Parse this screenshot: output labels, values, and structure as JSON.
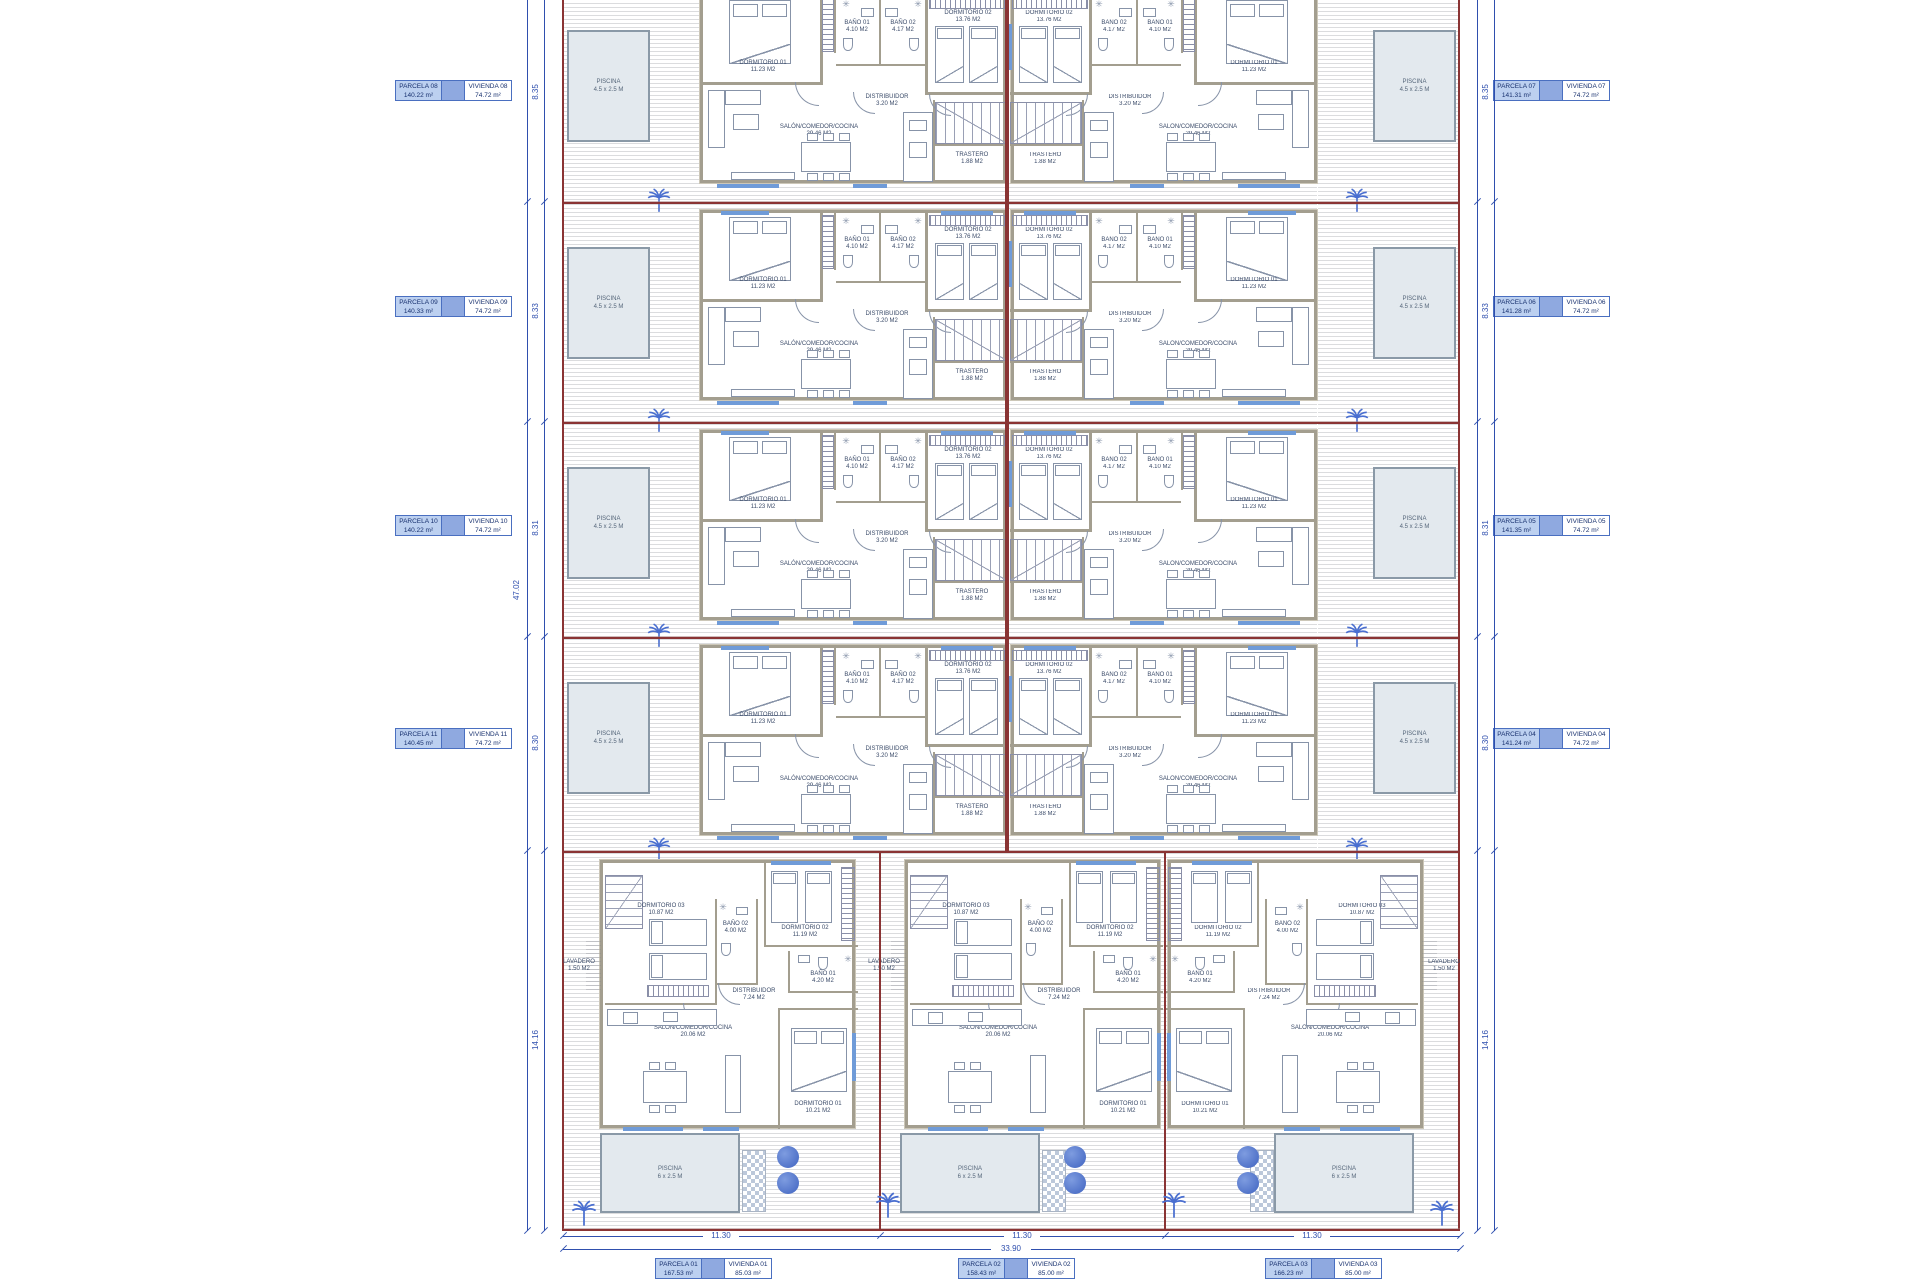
{
  "parcel_labels": {
    "left": [
      {
        "parcela": "PARCELA 08",
        "parcela_area": "140.22 m²",
        "vivienda": "VIVIENDA 08",
        "vivienda_area": "74.72 m²"
      },
      {
        "parcela": "PARCELA 09",
        "parcela_area": "140.33 m²",
        "vivienda": "VIVIENDA 09",
        "vivienda_area": "74.72 m²"
      },
      {
        "parcela": "PARCELA 10",
        "parcela_area": "140.22 m²",
        "vivienda": "VIVIENDA 10",
        "vivienda_area": "74.72 m²"
      },
      {
        "parcela": "PARCELA 11",
        "parcela_area": "140.45 m²",
        "vivienda": "VIVIENDA 11",
        "vivienda_area": "74.72 m²"
      }
    ],
    "right": [
      {
        "parcela": "PARCELA 07",
        "parcela_area": "141.31 m²",
        "vivienda": "VIVIENDA 07",
        "vivienda_area": "74.72 m²"
      },
      {
        "parcela": "PARCELA 06",
        "parcela_area": "141.28 m²",
        "vivienda": "VIVIENDA 06",
        "vivienda_area": "74.72 m²"
      },
      {
        "parcela": "PARCELA 05",
        "parcela_area": "141.35 m²",
        "vivienda": "VIVIENDA 05",
        "vivienda_area": "74.72 m²"
      },
      {
        "parcela": "PARCELA 04",
        "parcela_area": "141.24 m²",
        "vivienda": "VIVIENDA 04",
        "vivienda_area": "74.72 m²"
      }
    ],
    "bottom": [
      {
        "parcela": "PARCELA 01",
        "parcela_area": "167.53 m²",
        "vivienda": "VIVIENDA 01",
        "vivienda_area": "85.03 m²"
      },
      {
        "parcela": "PARCELA 02",
        "parcela_area": "158.43 m²",
        "vivienda": "VIVIENDA 02",
        "vivienda_area": "85.00 m²"
      },
      {
        "parcela": "PARCELA 03",
        "parcela_area": "166.23 m²",
        "vivienda": "VIVIENDA 03",
        "vivienda_area": "85.00 m²"
      }
    ]
  },
  "rooms": {
    "upper": {
      "d01": {
        "name": "DORMITORIO 01",
        "area": "11.23 M2"
      },
      "d02": {
        "name": "DORMITORIO 02",
        "area": "13.76 M2"
      },
      "b1": {
        "name": "BAÑO 01",
        "area": "4.10 M2"
      },
      "b2": {
        "name": "BAÑO 02",
        "area": "4.17 M2"
      },
      "dist": {
        "name": "DISTRIBUIDOR",
        "area": "3.20 M2"
      },
      "salon": {
        "name": "SALÓN/COMEDOR/COCINA",
        "area": "29.46 M2"
      },
      "trastero": {
        "name": "TRASTERO",
        "area": "1.88 M2"
      }
    },
    "lower": {
      "d01": {
        "name": "DORMITORIO 01",
        "area": "10.21 M2"
      },
      "d02": {
        "name": "DORMITORIO 02",
        "area": "11.19 M2"
      },
      "d03": {
        "name": "DORMITORIO 03",
        "area": "10.87 M2"
      },
      "b1": {
        "name": "BAÑO 01",
        "area": "4.20 M2"
      },
      "b2": {
        "name": "BAÑO 02",
        "area": "4.00 M2"
      },
      "dist": {
        "name": "DISTRIBUIDOR",
        "area": "7.24 M2"
      },
      "salon": {
        "name": "SALÓN/COMEDOR/COCINA",
        "area": "20.06 M2"
      },
      "lav": {
        "name": "LAVADERO",
        "area": "1.50 M2"
      }
    }
  },
  "pools": {
    "upper": {
      "title": "PISCINA",
      "size": "4.5 x 2.5 M"
    },
    "lower": {
      "title": "PISCINA",
      "size": "6 x 2.5 M"
    }
  },
  "dimensions": {
    "left_total": "47.02",
    "row_heights": [
      "8.35",
      "8.33",
      "8.31",
      "8.30",
      "14.16"
    ],
    "bottom_units": [
      "11.30",
      "11.30",
      "11.30"
    ],
    "bottom_total": "33.90"
  },
  "colors": {
    "boundary_red": "#8a3434",
    "dimension_blue": "#2f4fae",
    "label_fill": "#bcd0f0",
    "label_band": "#8fa9e0",
    "label_border": "#4a6fc0",
    "vegetation_blue": "#4a6fd0",
    "wall_gray": "#a39e8f",
    "pool_fill": "#e3e9ee"
  }
}
